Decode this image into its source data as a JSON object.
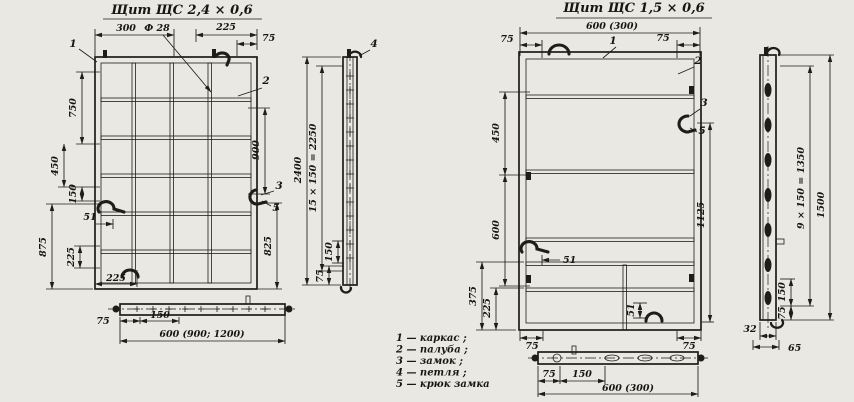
{
  "palette": {
    "paper": "#e9e8e2",
    "ink": "#1d1d1b"
  },
  "left": {
    "title": "Щит  ЩС  2,4 × 0,6",
    "front": {
      "d300": "300",
      "df28": "Ф 28",
      "d225_top": "225",
      "d75_top": "75",
      "d750": "750",
      "d450": "450",
      "d150": "150",
      "d875": "875",
      "d225_left": "225",
      "d51": "51",
      "d225_bottom": "225",
      "d900": "900",
      "d825": "825"
    },
    "side": {
      "d2400": "2400",
      "d2250": "15 × 150 = 2250",
      "d150": "150",
      "d75": "75"
    },
    "bottom": {
      "d75": "75",
      "d150": "150",
      "d600": "600 (900; 1200)"
    },
    "callouts": {
      "c1": "1",
      "c2": "2",
      "c3": "3",
      "c4": "4",
      "c5": "5"
    }
  },
  "right": {
    "title": "Щит  ЩС  1,5 × 0,6",
    "front": {
      "d600_top": "600 (300)",
      "d75_tl": "75",
      "d75_tr": "75",
      "d450": "450",
      "d600": "600",
      "d375": "375",
      "d225": "225",
      "d51_mid": "51",
      "d1125": "1125",
      "d51_bottom": "51",
      "d75_bl": "75",
      "d75_br": "75"
    },
    "side": {
      "d1350": "9 × 150 = 1350",
      "d1500": "1500",
      "d150": "150",
      "d75": "75",
      "d32": "32",
      "d65": "65"
    },
    "bottom": {
      "d75": "75",
      "d150": "150",
      "d600": "600 (300)"
    },
    "callouts": {
      "c1": "1",
      "c2": "2",
      "c3": "3",
      "c5": "5"
    }
  },
  "legend": {
    "items": {
      "i1": "1 — каркас ;",
      "i2": "2 — палуба ;",
      "i3": "3 — замок ;",
      "i4": "4 — петля ;",
      "i5": "5 — крюк замка"
    }
  }
}
